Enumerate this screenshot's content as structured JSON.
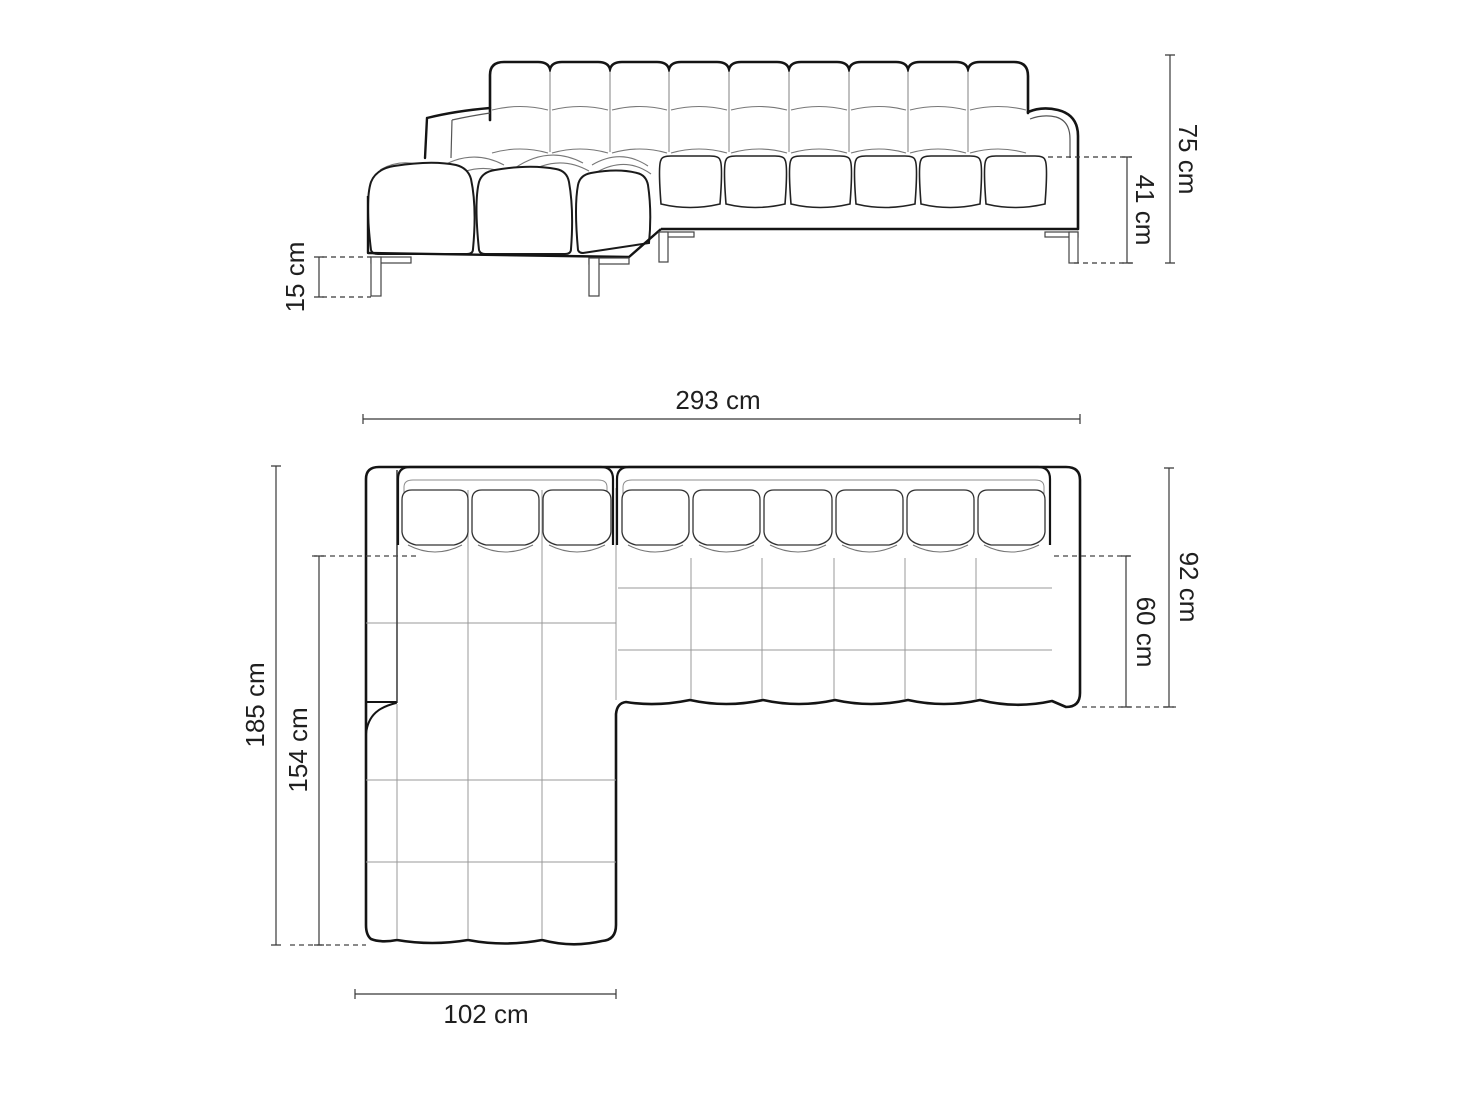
{
  "page": {
    "type": "product-dimension-diagram",
    "subject": "corner sofa with chaise longue, tufted (quilted) upholstery, metal runner legs",
    "background": "#ffffff"
  },
  "colors": {
    "outline_bold": "#141414",
    "outline_medium": "#333333",
    "seam_thin": "#8c8c8c",
    "dimension_line": "#383838",
    "label_text": "#1f1f1f",
    "background": "#ffffff"
  },
  "front_view": {
    "name": "front elevation view",
    "dimensions": {
      "total_height": "75 cm",
      "seat_height": "41 cm",
      "leg_height": "15 cm"
    }
  },
  "top_view": {
    "name": "top plan view",
    "dimensions": {
      "total_width": "293 cm",
      "total_depth": "92 cm",
      "seat_depth": "60 cm",
      "chaise_depth": "185 cm",
      "chaise_inner_depth": "154 cm",
      "chaise_width": "102 cm"
    }
  }
}
